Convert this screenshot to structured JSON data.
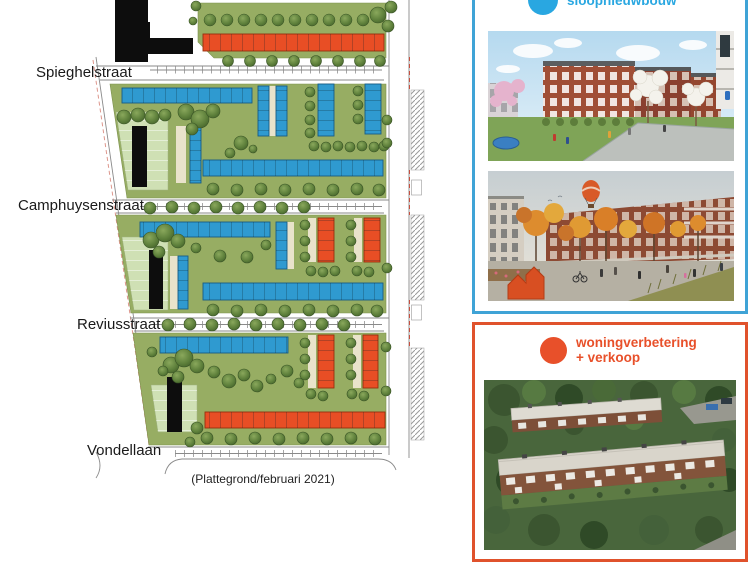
{
  "page": {
    "caption": "(Plattegrond/februari 2021)"
  },
  "map": {
    "streets": [
      {
        "label": "Spieghelstraat"
      },
      {
        "label": "Camphuysenstraat"
      },
      {
        "label": "Reviusstraat"
      },
      {
        "label": "Vondellaan"
      }
    ]
  },
  "legend": {
    "blue": {
      "label": "sloopnieuwbouw",
      "color": "#29a7e1"
    },
    "orange": {
      "label_line1": "woningverbetering",
      "label_line2": "+ verkoop",
      "color": "#e8502a"
    }
  },
  "colors": {
    "legend-blue": "#29a7e1",
    "legend-orange": "#e8502a",
    "panel-blue-border": "#3fa3d6",
    "panel-orange-border": "#e0522c",
    "building-blue": "#2f9ad0",
    "building-orange": "#e84e25",
    "building-black": "#0d0d0d",
    "map-green": "#97ad63",
    "map-light-green": "#cfe0b4",
    "path-cream": "#e9e3cb",
    "tree-green": "#5f813c"
  }
}
